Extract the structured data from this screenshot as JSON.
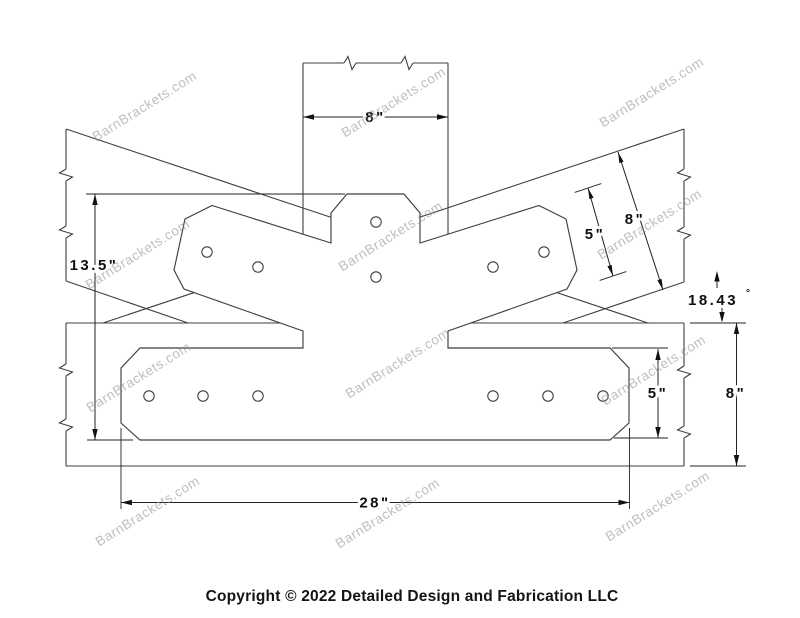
{
  "drawing": {
    "dimensions": {
      "post_width": "8\"",
      "arm_width": "5\"",
      "rafter_depth": "8\"",
      "angle_value": "18.43",
      "angle_unit": "°",
      "overall_height": "13.5\"",
      "plate_height": "5\"",
      "beam_depth": "8\"",
      "plate_length": "28\""
    },
    "watermark": {
      "text": "BarnBrackets.com"
    },
    "footer": {
      "copyright": "Copyright © 2022 Detailed Design and Fabrication LLC"
    }
  }
}
